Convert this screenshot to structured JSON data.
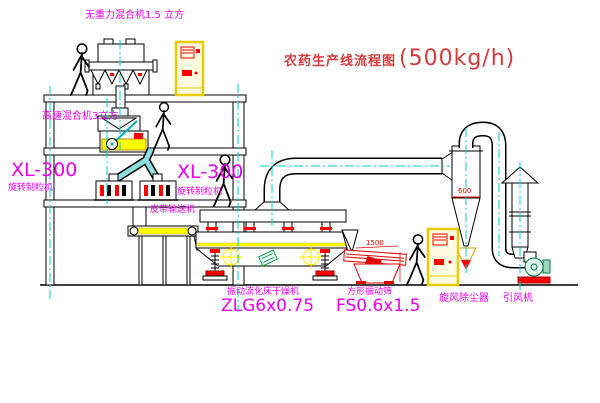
{
  "title": {
    "name": "农药生产线流程图",
    "capacity": "(500kg/h)"
  },
  "labels": {
    "gravity_mixer": "无重力混合机1.5 立方",
    "high_speed_mixer": "高速混合机3立方",
    "granulator_left_model": "XL-300",
    "granulator_left_name": "旋转制粒机",
    "granulator_mid_model": "XL-300",
    "granulator_mid_name": "旋转制粒机",
    "belt_conveyor": "皮带输送机",
    "fluid_bed_dryer_name": "振动流化床干燥机",
    "fluid_bed_dryer_model": "ZLG6x0.75",
    "vibrating_screen_name": "方形振动筛",
    "vibrating_screen_model": "FS0.6x1.5",
    "cyclone_collector": "旋风除尘器",
    "induced_draft_fan": "引风机"
  },
  "dimensions": {
    "cyclone_diameter": "600",
    "screen_length": "1500"
  },
  "colors": {
    "label_magenta": "#ee00ee",
    "title_red": "#d43c3c",
    "line_black": "#000000",
    "centerline_cyan": "#00cccc",
    "accent_yellow": "#ffff00",
    "accent_red": "#ff0000",
    "accent_green": "#00a050"
  }
}
